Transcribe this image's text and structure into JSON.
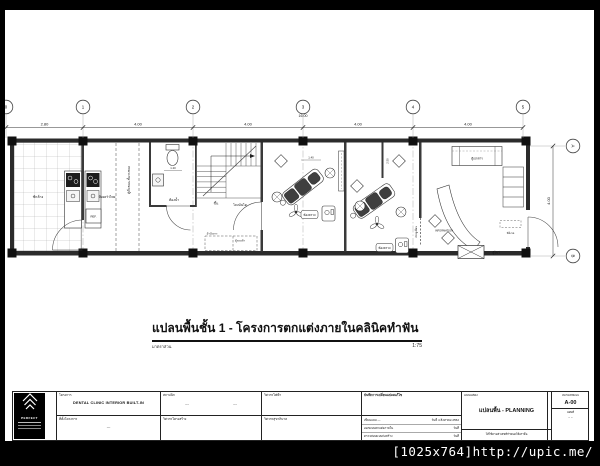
{
  "watermark": {
    "text": "[1025x764]http://upic.me/"
  },
  "title": {
    "text": "แปลนพื้นชั้น 1  -  โครงการตกแต่งภายในคลินิคทำฟัน",
    "scale_label": "มาตราส่วน",
    "scale_value": "1:75"
  },
  "grid": {
    "columns": [
      "0",
      "1",
      "2",
      "3",
      "4",
      "5"
    ],
    "rows": [
      "A",
      "B"
    ],
    "bay_dims": [
      "2.80",
      "4.00",
      "4.00",
      "4.00",
      "4.00"
    ],
    "total_dim": "16.00",
    "side_dim": "4.00"
  },
  "plan": {
    "wash_area": "ซักล้าง",
    "kitchen": "ห้องครัวไทย",
    "storage": "ตู้เก็บของ+ชั้นวางของ",
    "ref": "REF.",
    "bathroom": "ห้องน้ำ",
    "bath_dim": "1.20",
    "stair_up": "ขึ้น",
    "stair_hall": "โถงบันได",
    "bench": "ม้านั่งยาว",
    "shoe_cabinet": "ตู้รองเท้า",
    "exam_room_1": "ห้องตรวจ",
    "exam1_dim": "1.40",
    "exam_room_2": "ห้องตรวจ",
    "exam2_dim": "2.50",
    "sliding_door": "ประตูเลื่อน",
    "information": "INFORMATION",
    "document_cabinet": "ตู้เอกสาร",
    "display_cabinet": "ตู้โชว์",
    "waiting_seat": "ที่นั่งรอ"
  },
  "titleblock": {
    "logo_text": "PERFECT",
    "project_label": "โครงการ",
    "project_value": "DENTAL CLINIC INTERIOR BUILT-IN",
    "location_label": "ที่ตั้งโครงการ",
    "location_value": "---",
    "architect_label": "สถาปนิก",
    "architect_value": "---",
    "architect_value2": "---",
    "structural_label": "วิศวกรโครงสร้าง",
    "electrical_label": "วิศวกรไฟฟ้า",
    "sanitary_label": "วิศวกรสุขาภิบาล",
    "revision_label": "บันทึกการเปลี่ยนแปลงแก้ไข",
    "revision_rows": [
      {
        "label": "เขียนแบบ  ---",
        "value": "วันที่ 4 สิงหาคม 2552"
      },
      {
        "label": "ออกแบบตกแต่งภายใน",
        "value": "วันที่"
      },
      {
        "label": "ตรวจสอบแบบก่อสร้าง",
        "value": "วันที่"
      }
    ],
    "drawing_label": "แบบแสดง",
    "drawing_value": "แปลนพื้น - PLANNING",
    "drawing_note": "ให้ใช้ตามตัวเลขที่กำหนดให้เท่านั้น",
    "number_label": "หมายเลขแบบ",
    "number_value": "A-00",
    "sheet_label": "แผ่นที่",
    "sheet_value": "--  --"
  }
}
